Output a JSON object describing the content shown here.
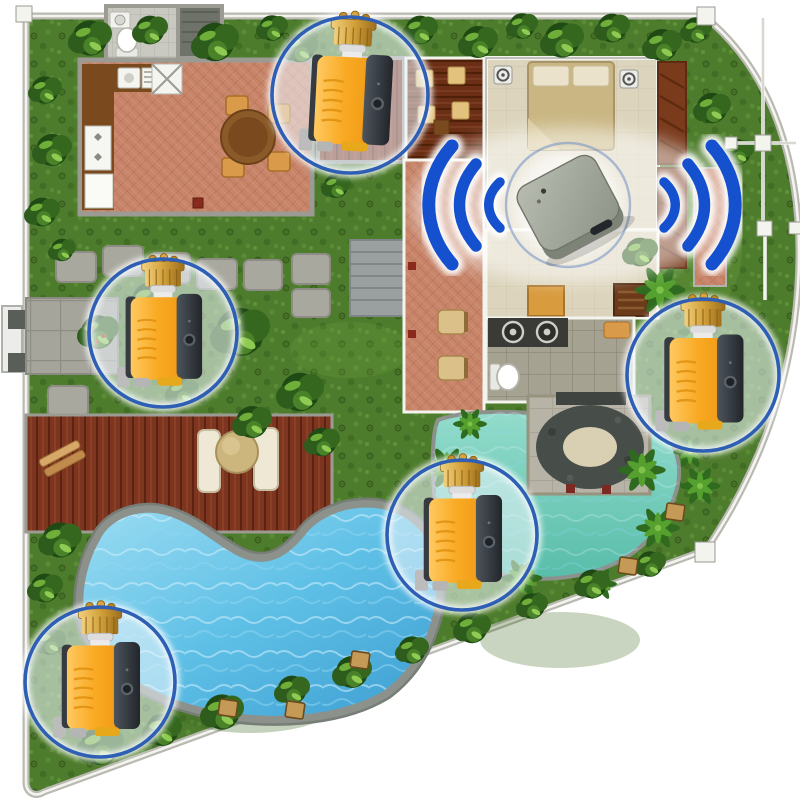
{
  "scene": {
    "name": "smart-irrigation-villa-floorplan",
    "description": "Aerial floor plan of a villa with garden and pool; five smart water valves shown in circular callouts communicate wirelessly with a central WiFi gateway hub",
    "visible_text": "",
    "device_count_valves": 5,
    "device_count_hubs": 1
  },
  "palette": {
    "wifi_blue": "#1551cf",
    "ring_blue": "#2e5fb4",
    "valve_yellow": "#f8a61e",
    "valve_dark": "#3a4046",
    "brass_gold": "#c8922e",
    "hub_gray": "#a9aea1",
    "grass_green": "#4e7c2d",
    "terracotta": "#c8856a",
    "pool_blue": "#58b7e0",
    "lagoon_teal": "#7fd0bf",
    "deck_brown": "#7e3520",
    "wall_gray": "#b9b9b2"
  },
  "hub": {
    "name": "wifi-gateway-hub",
    "transform": "translate(568,203)",
    "glow_r": 62
  },
  "callouts": {
    "top": {
      "device": "smart-water-valve",
      "transform": "translate(350,95)",
      "r": 78
    },
    "left": {
      "device": "smart-water-valve",
      "transform": "translate(163,333)",
      "r": 74
    },
    "right": {
      "device": "smart-water-valve",
      "transform": "translate(703,375)",
      "r": 76
    },
    "pool": {
      "device": "smart-water-valve",
      "transform": "translate(462,535)",
      "r": 75
    },
    "bottom": {
      "device": "smart-water-valve",
      "transform": "translate(100,682)",
      "r": 75
    }
  }
}
